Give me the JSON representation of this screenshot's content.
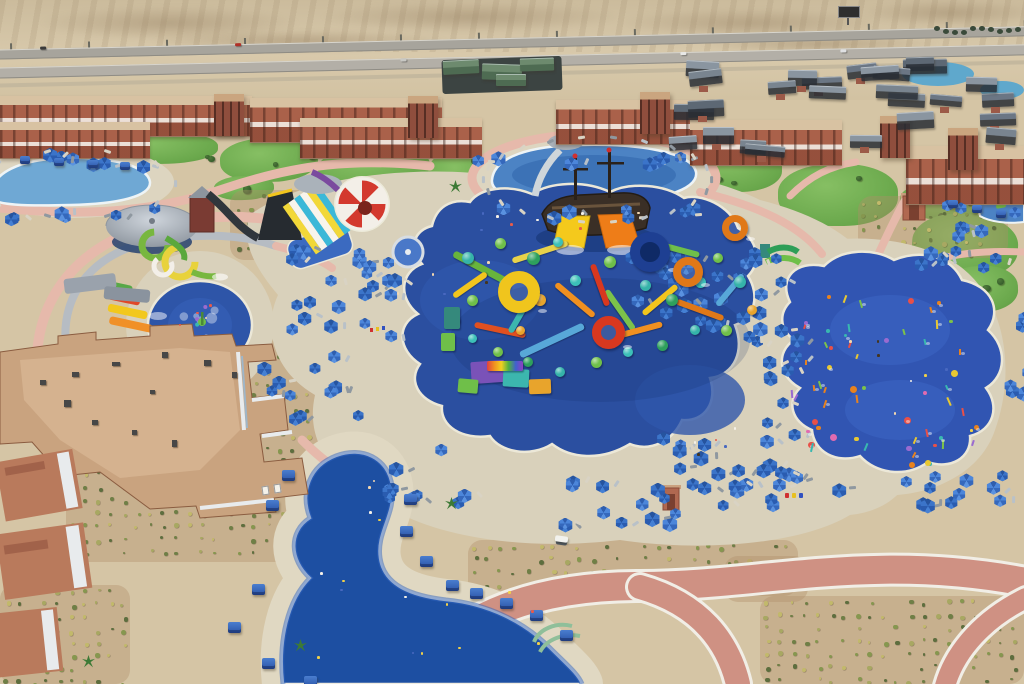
{
  "meta": {
    "description": "Aerial drone photograph of a desert waterpark resort: terracotta hotel buildings along a highway, a large deep-blue splash pad with a colorful aqua play structure and pirate ship, a red and white checkered funnel slide, racing slides, spiral slides, a round pool, a kids splash circle, a spray ground with colorful water toys, blue parasols on tan decks, and an S-shaped lagoon pool with blue cabanas."
  },
  "palette": {
    "sand": "#d5c5a5",
    "sand_dark": "#c5ae8a",
    "deck": "#d9d1bb",
    "path_pink": "#e6b9ab",
    "path_red": "#cf9183",
    "pool_blue": "#4c83c4",
    "pad_blue": "#2b4fa0",
    "pad_blue_right": "#3155b2",
    "lagoon_blue": "#1d4fa2",
    "umbrella_blue": "#2f63b8",
    "terracotta": "#aa614a",
    "terracotta_dark": "#8f4e3d",
    "roof_grey": "#6b7684",
    "lawn_green": "#74ad52",
    "structure_teal": "#35b3a9",
    "slide_yellow": "#f2c51d",
    "slide_orange": "#ee8418",
    "slide_red": "#d8381f",
    "slide_green": "#6fbf49",
    "coping_white": "#f2efe6"
  },
  "scene": {
    "desert": {
      "dunes": [
        [
          40,
          6,
          260,
          34
        ],
        [
          320,
          2,
          300,
          30
        ],
        [
          620,
          8,
          260,
          30
        ],
        [
          860,
          0,
          180,
          26
        ],
        [
          150,
          30,
          300,
          22
        ],
        [
          700,
          34,
          240,
          20
        ]
      ]
    },
    "highway": {
      "top": 44,
      "rot": -1.3,
      "post_step": 78,
      "cars": [
        [
          60,
          4,
          "#3a3a3a"
        ],
        [
          255,
          5,
          "#b03028"
        ],
        [
          700,
          24,
          "#e8e8e6"
        ],
        [
          860,
          25,
          "#dfe0e2"
        ],
        [
          420,
          24,
          "#c8c8c4"
        ]
      ]
    },
    "billboard": [
      838,
      6
    ],
    "treeline": {
      "x0": 934,
      "x1": 1024,
      "y": 26,
      "step": 9
    },
    "building_strips": [
      [
        0,
        96,
        252,
        40
      ],
      [
        250,
        98,
        192,
        44
      ],
      [
        0,
        122,
        150,
        36
      ],
      [
        300,
        118,
        182,
        40
      ],
      [
        556,
        100,
        148,
        44
      ],
      [
        690,
        120,
        152,
        45
      ],
      [
        906,
        146,
        118,
        58
      ]
    ],
    "building_towers": [
      [
        214,
        94
      ],
      [
        408,
        96
      ],
      [
        640,
        92
      ],
      [
        880,
        116
      ],
      [
        948,
        128
      ]
    ],
    "chalets": {
      "x": 662,
      "y": 56,
      "w": 356,
      "h": 104,
      "n": 26,
      "colors": [
        "#5d6874",
        "#6b7684",
        "#79848f",
        "#8a95a0"
      ]
    },
    "green_roofs": [
      [
        443,
        60,
        36,
        14,
        -3
      ],
      [
        482,
        64,
        40,
        16,
        2
      ],
      [
        520,
        58,
        34,
        13,
        -2
      ],
      [
        496,
        74,
        30,
        12,
        0
      ]
    ],
    "lawns": [
      [
        0,
        124,
        96,
        40
      ],
      [
        96,
        132,
        122,
        32
      ],
      [
        220,
        138,
        98,
        44
      ],
      [
        318,
        146,
        112,
        44
      ],
      [
        428,
        150,
        66,
        50
      ],
      [
        688,
        146,
        94,
        46
      ],
      [
        778,
        164,
        120,
        62
      ],
      [
        900,
        184,
        84,
        36
      ],
      [
        912,
        214,
        106,
        64
      ],
      [
        850,
        246,
        66,
        30
      ],
      [
        944,
        266,
        74,
        46
      ],
      [
        694,
        194,
        72,
        36
      ],
      [
        608,
        214,
        60,
        20
      ],
      [
        214,
        176,
        60,
        24
      ]
    ],
    "shrub_fields": [
      [
        66,
        468,
        258,
        94
      ],
      [
        248,
        338,
        100,
        134
      ],
      [
        426,
        468,
        262,
        58
      ],
      [
        468,
        540,
        330,
        56
      ],
      [
        724,
        556,
        84,
        46
      ],
      [
        760,
        596,
        264,
        88
      ],
      [
        0,
        585,
        130,
        99
      ],
      [
        858,
        196,
        150,
        62
      ],
      [
        230,
        190,
        180,
        70
      ]
    ],
    "umbrella_clusters": [
      [
        268,
        244,
        132,
        88,
        22
      ],
      [
        256,
        350,
        100,
        76,
        12
      ],
      [
        616,
        240,
        100,
        80,
        16
      ],
      [
        700,
        240,
        80,
        100,
        16
      ],
      [
        758,
        330,
        36,
        110,
        10
      ],
      [
        376,
        436,
        104,
        64,
        10
      ],
      [
        540,
        472,
        190,
        46,
        16
      ],
      [
        640,
        430,
        60,
        34,
        6
      ],
      [
        808,
        470,
        190,
        40,
        12
      ],
      [
        748,
        448,
        56,
        40,
        6
      ],
      [
        996,
        306,
        28,
        128,
        8
      ],
      [
        900,
        242,
        90,
        22,
        7
      ],
      [
        4,
        146,
        150,
        14,
        7
      ],
      [
        0,
        198,
        152,
        16,
        7
      ],
      [
        470,
        148,
        220,
        12,
        7
      ],
      [
        474,
        200,
        228,
        12,
        7
      ],
      [
        930,
        198,
        90,
        36,
        7
      ],
      [
        690,
        462,
        92,
        40,
        8
      ]
    ],
    "cabanas": {
      "size": 13,
      "positions": [
        [
          282,
          470
        ],
        [
          266,
          500
        ],
        [
          404,
          494
        ],
        [
          400,
          526
        ],
        [
          420,
          556
        ],
        [
          446,
          580
        ],
        [
          470,
          588
        ],
        [
          500,
          598
        ],
        [
          530,
          610
        ],
        [
          560,
          630
        ],
        [
          252,
          584
        ],
        [
          228,
          622
        ],
        [
          262,
          658
        ],
        [
          304,
          676
        ]
      ]
    },
    "cabanas_small": {
      "size": 10,
      "positions": [
        [
          20,
          156
        ],
        [
          54,
          158
        ],
        [
          88,
          160
        ],
        [
          120,
          162
        ],
        [
          948,
          200
        ],
        [
          972,
          205
        ],
        [
          996,
          210
        ]
      ]
    },
    "lounger_rings": [
      [
        594,
        178,
        114,
        42,
        22
      ],
      [
        74,
        182,
        98,
        34,
        10
      ]
    ],
    "play_dots": [
      [
        468,
        258,
        12,
        "#35b3a9"
      ],
      [
        500,
        243,
        11,
        "#6fbf49"
      ],
      [
        533,
        258,
        13,
        "#2ea05c"
      ],
      [
        558,
        242,
        10,
        "#3cc0b8"
      ],
      [
        472,
        300,
        11,
        "#6fbf49"
      ],
      [
        505,
        285,
        12,
        "#35b3a9"
      ],
      [
        540,
        300,
        12,
        "#e8a42c"
      ],
      [
        575,
        280,
        11,
        "#3cc0b8"
      ],
      [
        610,
        262,
        12,
        "#6fbf49"
      ],
      [
        645,
        285,
        11,
        "#35b3a9"
      ],
      [
        672,
        300,
        12,
        "#2ea05c"
      ],
      [
        700,
        282,
        11,
        "#3cc0b8"
      ],
      [
        718,
        258,
        10,
        "#6fbf49"
      ],
      [
        740,
        282,
        12,
        "#35b3a9"
      ],
      [
        752,
        310,
        10,
        "#e8a42c"
      ],
      [
        726,
        330,
        11,
        "#6fbf49"
      ],
      [
        695,
        330,
        10,
        "#35b3a9"
      ],
      [
        662,
        345,
        11,
        "#2ea05c"
      ],
      [
        628,
        352,
        10,
        "#3cc0b8"
      ],
      [
        596,
        362,
        11,
        "#6fbf49"
      ],
      [
        560,
        372,
        10,
        "#35b3a9"
      ],
      [
        528,
        362,
        10,
        "#2ea05c"
      ],
      [
        498,
        352,
        10,
        "#6fbf49"
      ],
      [
        472,
        338,
        9,
        "#3cc0b8"
      ],
      [
        455,
        320,
        9,
        "#2ea05c"
      ],
      [
        520,
        330,
        9,
        "#e8a42c"
      ]
    ],
    "play_rings": [
      [
        650,
        252,
        40,
        "#1e3f92",
        10,
        "#0f2a66"
      ],
      [
        688,
        272,
        30,
        "#e07818",
        8,
        ""
      ],
      [
        608,
        332,
        33,
        "#d8381f",
        9,
        ""
      ],
      [
        519,
        292,
        42,
        "#f0c51d",
        12,
        ""
      ],
      [
        735,
        228,
        26,
        "#e07818",
        7,
        ""
      ]
    ],
    "play_tubes": [
      [
        482,
        268,
        64,
        7,
        "#68b43c",
        28
      ],
      [
        540,
        252,
        58,
        6,
        "#e8d24a",
        -18
      ],
      [
        575,
        300,
        50,
        6,
        "#f09020",
        40
      ],
      [
        552,
        340,
        70,
        7,
        "#58a8d8",
        -25
      ],
      [
        500,
        330,
        52,
        6,
        "#e05020",
        12
      ],
      [
        620,
        310,
        48,
        6,
        "#7cc24a",
        55
      ],
      [
        660,
        300,
        44,
        6,
        "#f2c51d",
        -40
      ],
      [
        700,
        310,
        50,
        6,
        "#e07818",
        20
      ],
      [
        730,
        290,
        40,
        6,
        "#58a8d8",
        -50
      ],
      [
        600,
        285,
        44,
        6,
        "#d8381f",
        70
      ],
      [
        520,
        315,
        40,
        6,
        "#3cb6ae",
        -60
      ],
      [
        640,
        330,
        46,
        6,
        "#f09020",
        -15
      ],
      [
        680,
        250,
        40,
        6,
        "#6fbf49",
        15
      ],
      [
        470,
        285,
        40,
        6,
        "#f2c51d",
        -35
      ]
    ],
    "play_blocks": [
      [
        488,
        372,
        34,
        22,
        "#7a52b8",
        -4
      ],
      [
        516,
        378,
        26,
        18,
        "#3cb6ae",
        3
      ],
      [
        540,
        386,
        22,
        15,
        "#e8a42c",
        -2
      ],
      [
        468,
        386,
        20,
        14,
        "#6fbf49",
        5
      ],
      [
        505,
        366,
        36,
        10,
        "RAINBOW",
        0
      ],
      [
        452,
        318,
        16,
        22,
        "#35897c",
        0
      ],
      [
        448,
        342,
        14,
        18,
        "#6fbf49",
        0
      ]
    ],
    "spray_boxes": [
      [
        812,
        290,
        150,
        64,
        18
      ],
      [
        806,
        364,
        176,
        84,
        22
      ],
      [
        846,
        436,
        116,
        28,
        8
      ],
      [
        790,
        310,
        40,
        110,
        10
      ]
    ],
    "spray_colors": [
      "#e06bb0",
      "#e8c832",
      "#e8821e",
      "#7cc24a",
      "#39b8b0",
      "#9a6bd0",
      "#e85048"
    ],
    "people_boxes": [
      [
        470,
        200,
        170,
        36,
        8
      ],
      [
        310,
        560,
        230,
        100,
        12
      ],
      [
        335,
        470,
        56,
        56,
        4
      ],
      [
        830,
        300,
        150,
        150,
        8
      ],
      [
        390,
        256,
        110,
        56,
        5
      ],
      [
        650,
        420,
        110,
        50,
        5
      ],
      [
        172,
        304,
        56,
        42,
        4
      ]
    ],
    "people_colors": [
      "#f3d7b0",
      "#e85b4a",
      "#4868c0",
      "#f5f1e8",
      "#44351f",
      "#f0d048"
    ],
    "palms": [
      [
        451,
        503
      ],
      [
        88,
        661
      ],
      [
        300,
        645
      ],
      [
        455,
        186
      ]
    ],
    "bins": [
      [
        785,
        493,
        "#d03030"
      ],
      [
        792,
        493,
        "#e8c020"
      ],
      [
        799,
        493,
        "#3050c0"
      ]
    ],
    "flags": [
      [
        370,
        328,
        "#d03030"
      ],
      [
        376,
        327,
        "#e8c020"
      ],
      [
        382,
        326,
        "#3050c0"
      ]
    ],
    "signs": [
      [
        262,
        486
      ],
      [
        274,
        484
      ]
    ],
    "golf_cart": [
      556,
      536
    ],
    "funnel": {
      "cx": 362,
      "cy": 204,
      "r": 25
    },
    "ac_units": [
      [
        40,
        380
      ],
      [
        72,
        372
      ],
      [
        112,
        362
      ],
      [
        162,
        352
      ],
      [
        204,
        360
      ],
      [
        232,
        372
      ],
      [
        92,
        420
      ],
      [
        132,
        430
      ],
      [
        172,
        440
      ],
      [
        64,
        400
      ],
      [
        150,
        390
      ]
    ]
  }
}
